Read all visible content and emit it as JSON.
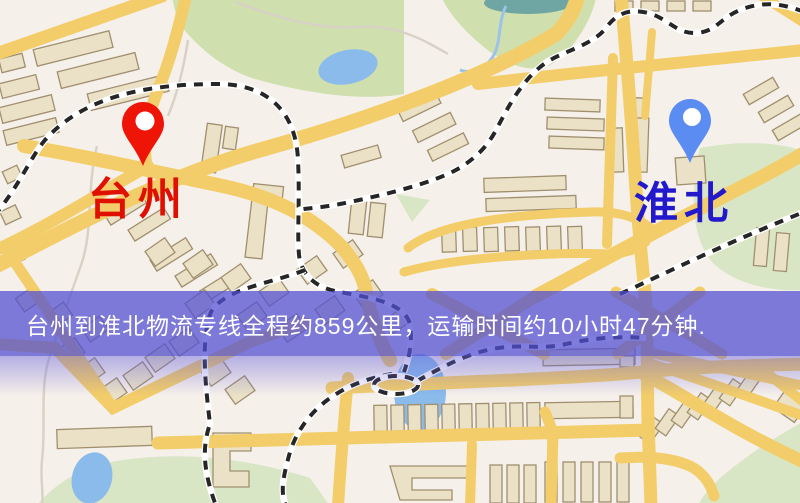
{
  "banner": {
    "text": "台州到淮北物流专线全程约859公里，运输时间约10小时47分钟.",
    "background_color": "#5250d2",
    "text_color": "#ffffff"
  },
  "route": {
    "origin": "台州",
    "destination": "淮北",
    "distance": "约859公里",
    "duration": "约10小时47分钟"
  },
  "markers": {
    "origin": {
      "label": "台州",
      "pin_color": "#ee1506",
      "label_color": "#e01000"
    },
    "destination": {
      "label": "淮北",
      "pin_color": "#5b8cf2",
      "label_color": "#2218cc"
    }
  },
  "map_palette": {
    "background": "#f6f0ea",
    "road": "#f3cd69",
    "park": "#cfdfae",
    "water": "#8abbea",
    "building": "#eae1c6",
    "railway": "#262626"
  }
}
